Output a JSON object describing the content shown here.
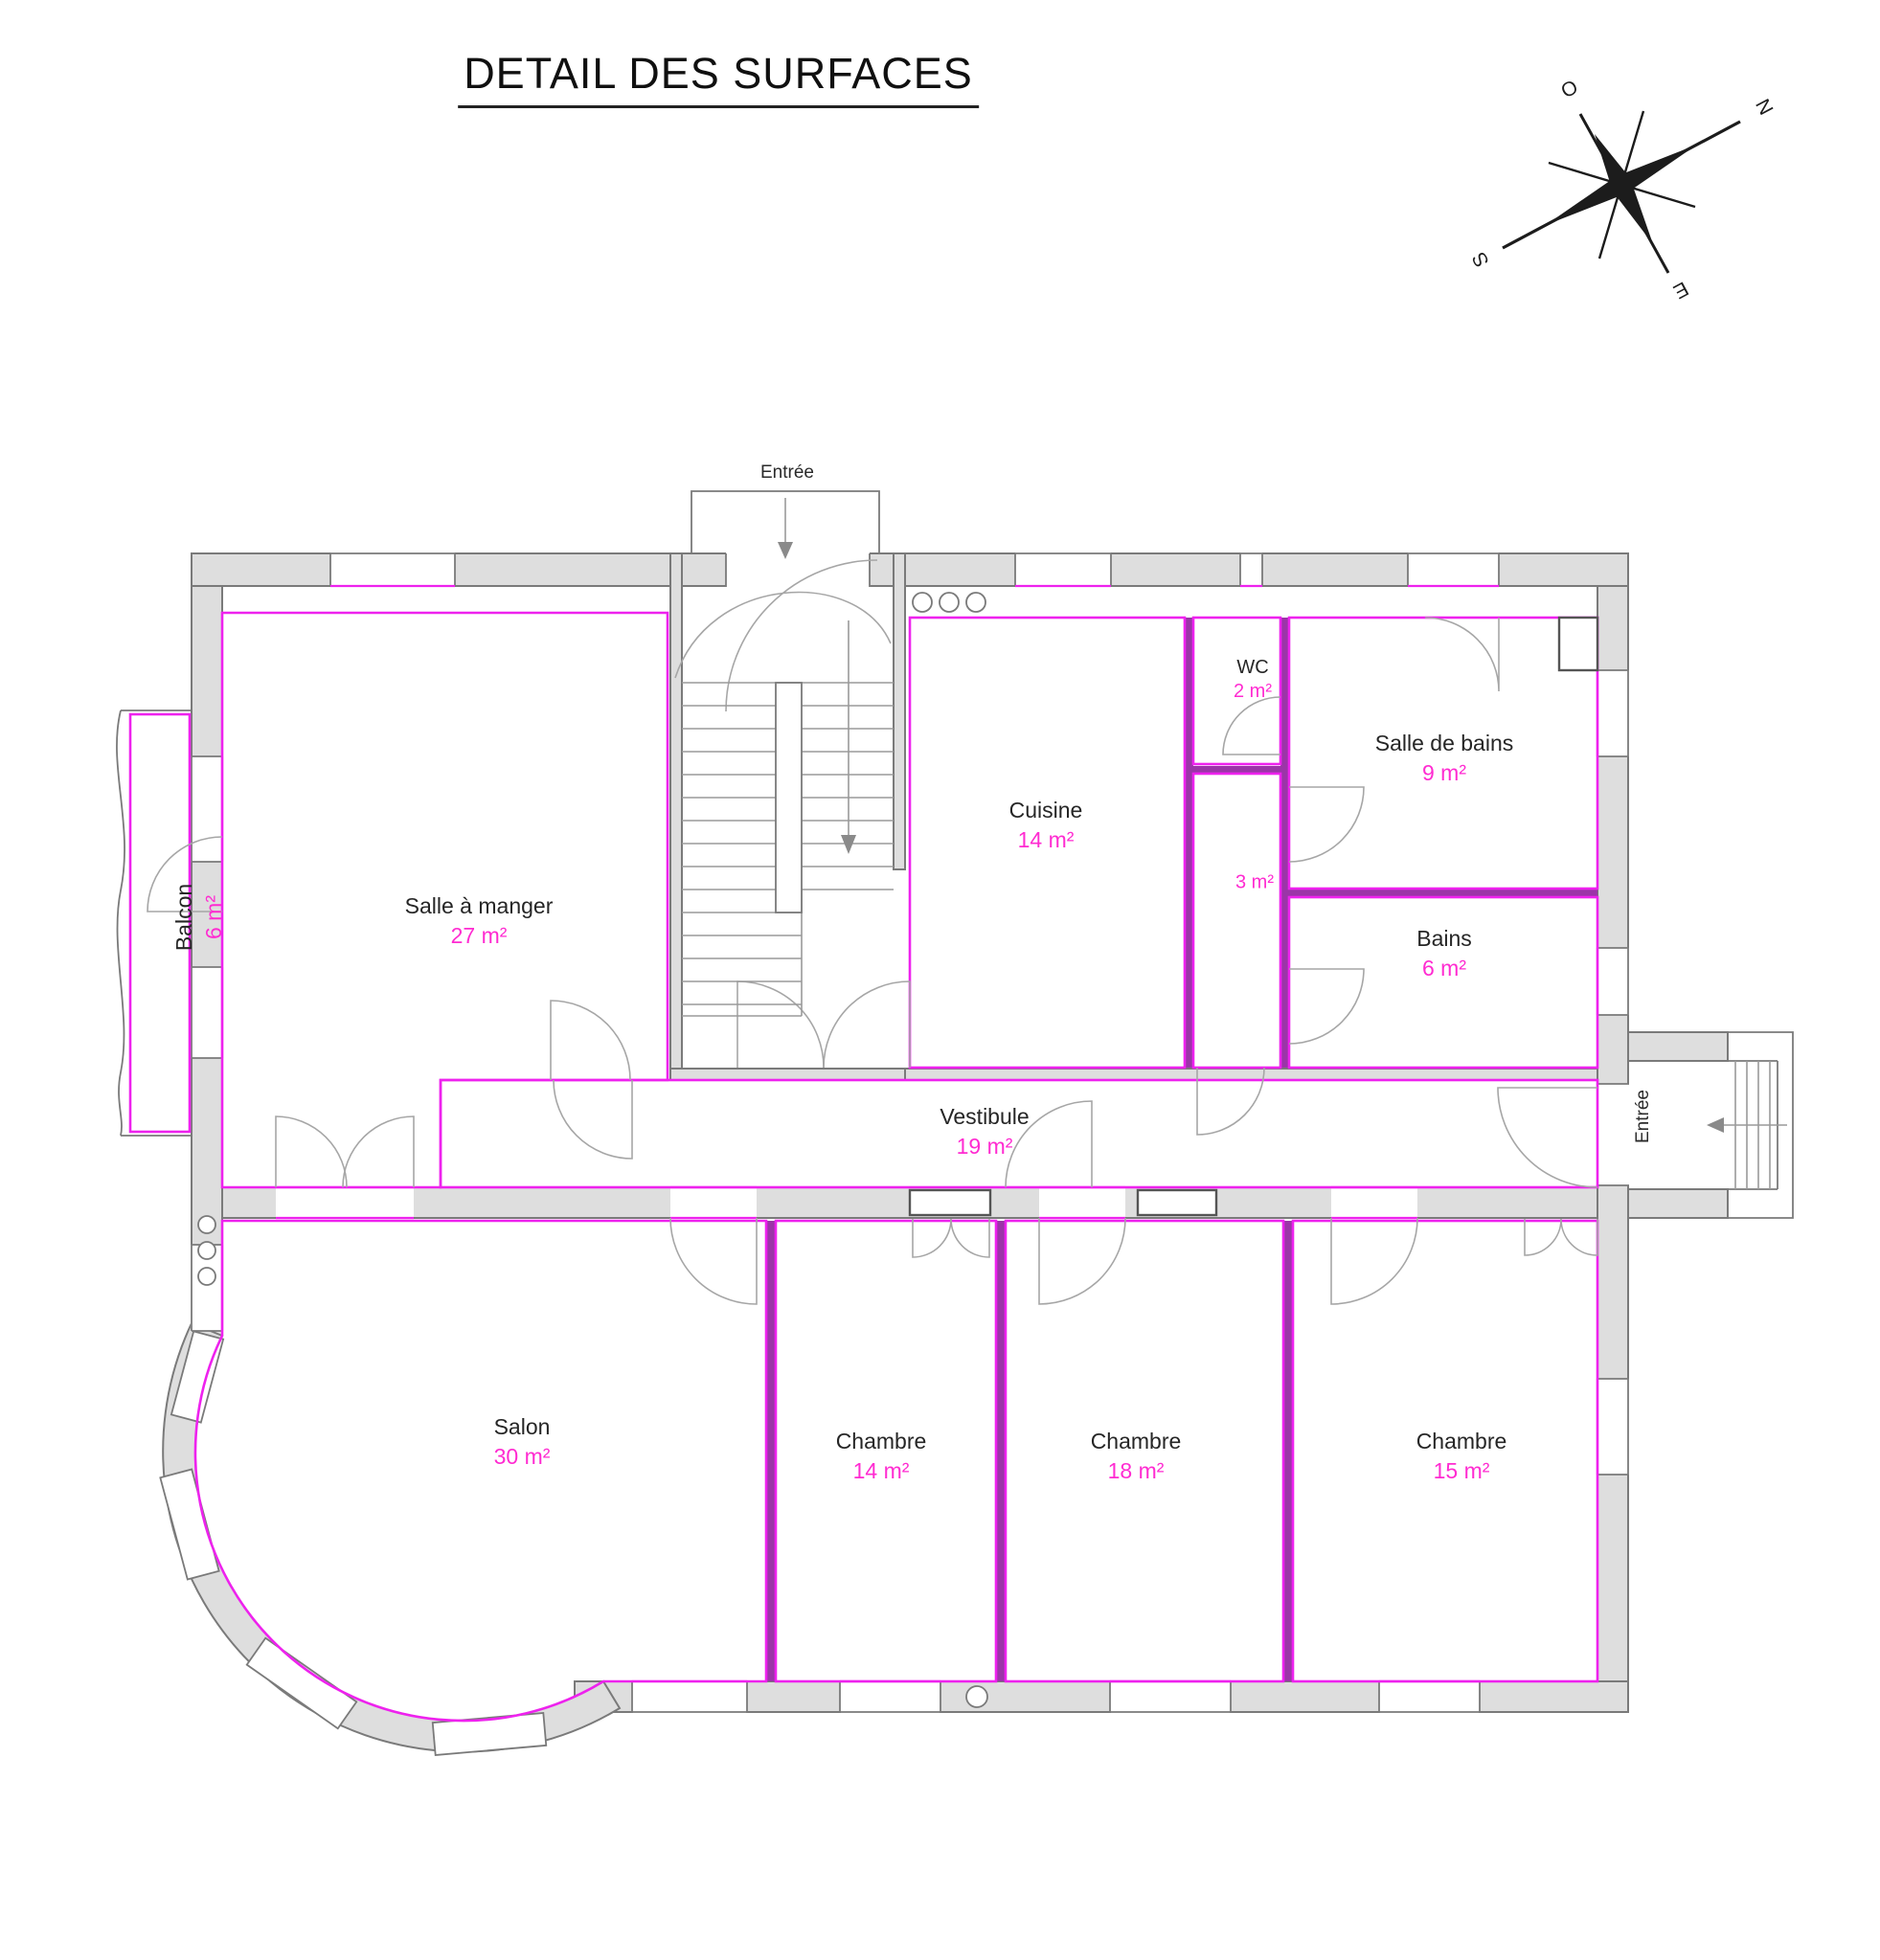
{
  "title": "DETAIL DES SURFACES",
  "compass": {
    "north": "N",
    "west": "O",
    "south": "S",
    "east": "E"
  },
  "entrances": {
    "top": "Entrée",
    "side": "Entrée"
  },
  "rooms": [
    {
      "name": "Balcon",
      "area": "6 m²"
    },
    {
      "name": "Salle à manger",
      "area": "27 m²"
    },
    {
      "name": "Cuisine",
      "area": "14 m²"
    },
    {
      "name": "WC",
      "area": "2 m²"
    },
    {
      "name": "",
      "area": "3 m²"
    },
    {
      "name": "Salle de bains",
      "area": "9 m²"
    },
    {
      "name": "Bains",
      "area": "6 m²"
    },
    {
      "name": "Vestibule",
      "area": "19 m²"
    },
    {
      "name": "Salon",
      "area": "30 m²"
    },
    {
      "name": "Chambre",
      "area": "14 m²"
    },
    {
      "name": "Chambre",
      "area": "18 m²"
    },
    {
      "name": "Chambre",
      "area": "15 m²"
    }
  ],
  "colors": {
    "wall_fill": "#dedede",
    "wall_stroke": "#7a7a7a",
    "room_outline": "#ee22ee",
    "partition": "#9b35a8",
    "area_text": "#ff2bd1",
    "label_text": "#262626",
    "door_arc": "#a6a6a6"
  }
}
